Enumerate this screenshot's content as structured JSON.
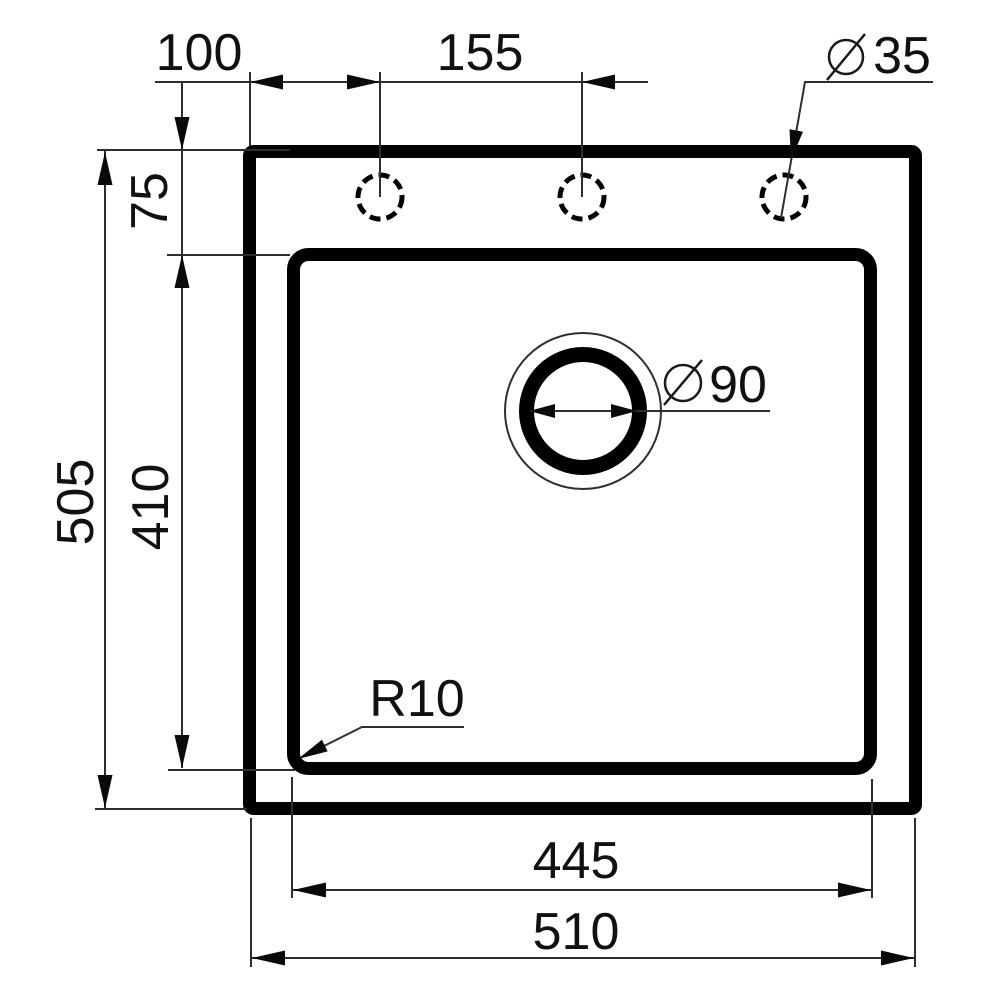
{
  "drawing": {
    "type": "technical-dimension-drawing",
    "subject": "kitchen sink top view with mounting dimensions",
    "background_color": "#ffffff",
    "line_color": "#000000",
    "dimensions": {
      "hole_offset_from_edge": "100",
      "hole_spacing": "155",
      "faucet_hole_diameter": "35",
      "rim_to_bowl_top": "75",
      "overall_depth": "505",
      "bowl_depth": "410",
      "drain_diameter": "90",
      "bowl_corner_radius": "R10",
      "bowl_width": "445",
      "overall_width": "510"
    }
  }
}
